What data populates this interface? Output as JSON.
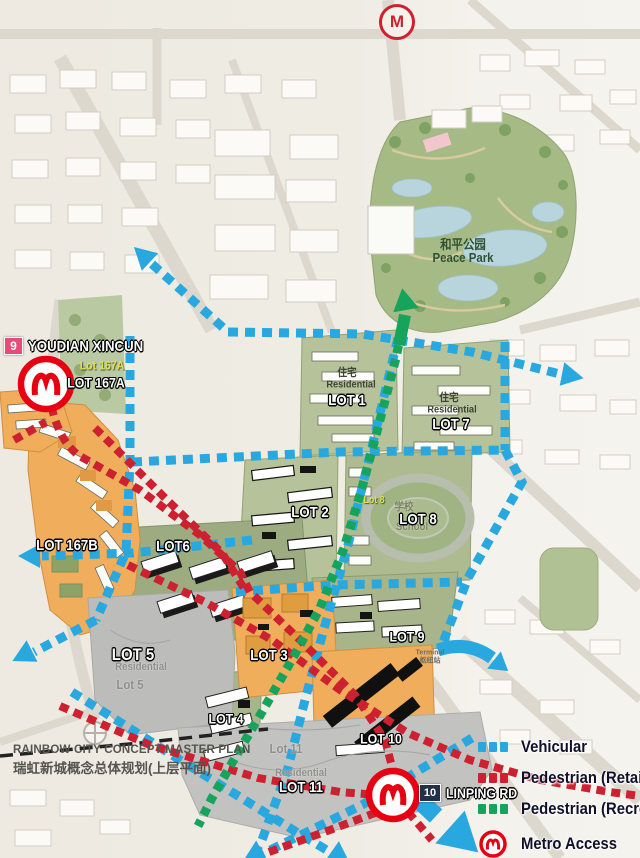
{
  "header": {
    "metro_marker": "M"
  },
  "stations": {
    "s9": {
      "badge": "9",
      "name": "YOUDIAN XINCUN"
    },
    "s10": {
      "badge": "10",
      "name": "LINPING RD"
    }
  },
  "park": {
    "name_zh": "和平公园",
    "name_en": "Peace Park"
  },
  "lots": {
    "lot167a_small": "Lot 167A",
    "lot167a": "LOT 167A",
    "lot167b": "LOT 167B",
    "zhuzhai": "住宅",
    "residential": "Residential",
    "lot1": "LOT 1",
    "lot7": "LOT 7",
    "lot2": "LOT 2",
    "lot8_small": "Lot 8",
    "school_zh": "学校",
    "school_en": "School",
    "lot8": "LOT 8",
    "lot6": "LOT6",
    "lot3": "LOT 3",
    "lot5": "LOT 5",
    "lot5_small": "Lot 5",
    "lot4": "LOT 4",
    "lot9": "LOT 9",
    "lot10": "LOT 10",
    "lot11_small": "Lot 11",
    "lot11": "LOT 11"
  },
  "terminal": {
    "en": "Terminal",
    "zh": "枢纽站"
  },
  "title": {
    "en": "RAINBOW CITY CONCEPT MASTER PLAN",
    "zh": "瑞虹新城概念总体规划(上层平面)"
  },
  "legend": {
    "items": [
      {
        "label": "Vehicular",
        "color": "#29a8e0"
      },
      {
        "label": "Pedestrian (Retail)",
        "color": "#cd2030"
      },
      {
        "label": "Pedestrian (Recreation)",
        "color": "#16a35b"
      },
      {
        "label": "Metro Access",
        "color": "#e60012"
      }
    ]
  }
}
